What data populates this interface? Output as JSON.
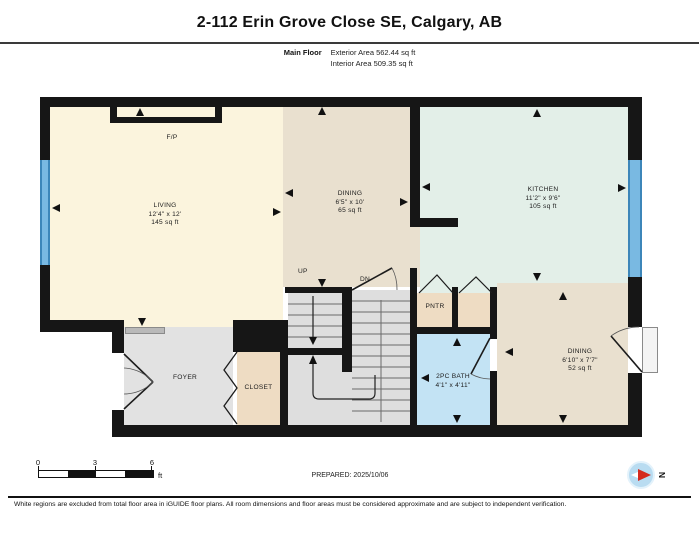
{
  "header": {
    "title": "2-112 Erin Grove Close SE, Calgary, AB",
    "floor_label": "Main Floor",
    "exterior_area": "Exterior Area 562.44 sq ft",
    "interior_area": "Interior Area 509.35 sq ft"
  },
  "rooms": {
    "living": {
      "name": "LIVING",
      "dims": "12'4\" x 12'",
      "area": "145 sq ft"
    },
    "dining": {
      "name": "DINING",
      "dims": "6'5\" x 10'",
      "area": "65 sq ft"
    },
    "kitchen": {
      "name": "KITCHEN",
      "dims": "11'2\" x 9'6\"",
      "area": "105 sq ft"
    },
    "dining2": {
      "name": "DINING",
      "dims": "6'10\" x 7'7\"",
      "area": "52 sq ft"
    },
    "bath": {
      "name": "2PC BATH",
      "dims": "4'1\" x 4'11\""
    },
    "foyer": {
      "name": "FOYER"
    },
    "closet": {
      "name": "CLOSET"
    },
    "pantry": {
      "name": "PNTR"
    },
    "fireplace": {
      "name": "F/P"
    }
  },
  "stairs": {
    "up_label": "UP",
    "down_label": "DN"
  },
  "scale_bar": {
    "ticks": [
      "0",
      "3",
      "6"
    ],
    "unit": "ft"
  },
  "prepared_label": "PREPARED: 2025/10/06",
  "compass": {
    "north_label": "N"
  },
  "footer": {
    "disclaimer": "White regions are excluded from total floor area in iGUIDE floor plans. All room dimensions and floor areas must be considered approximate and are subject to independent verification."
  },
  "colors": {
    "living": "#fbf4dd",
    "dining": "#e9e0cf",
    "kitchen": "#e3efe8",
    "bath": "#c3e3f4",
    "closet_pantry": "#eedcc3",
    "foyer_stairs": "#e2e2e2",
    "wall": "#161616",
    "window_blue": "#79b9e2",
    "compass_blue": "#b9dcf1",
    "compass_red": "#d42a1e"
  }
}
